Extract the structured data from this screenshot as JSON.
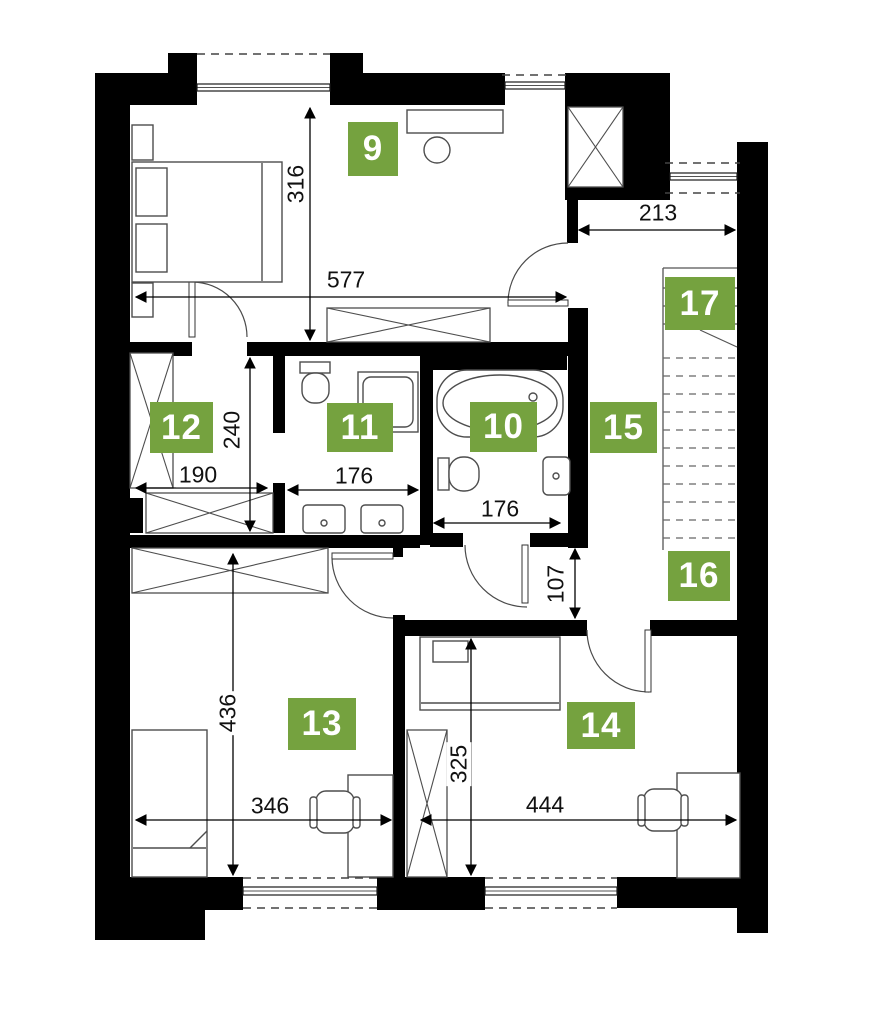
{
  "colors": {
    "wall": "#000000",
    "badge_green": "#75a23f",
    "furniture_line": "#4d4d4d",
    "dim_line": "#000000",
    "dash_line": "#444444"
  },
  "badges": [
    {
      "label": "9",
      "x": 348,
      "y": 122,
      "w": 50,
      "h": 54
    },
    {
      "label": "10",
      "x": 470,
      "y": 402,
      "w": 67,
      "h": 50
    },
    {
      "label": "11",
      "x": 327,
      "y": 403,
      "w": 66,
      "h": 49
    },
    {
      "label": "12",
      "x": 150,
      "y": 402,
      "w": 63,
      "h": 51
    },
    {
      "label": "13",
      "x": 288,
      "y": 698,
      "w": 68,
      "h": 52
    },
    {
      "label": "14",
      "x": 567,
      "y": 702,
      "w": 68,
      "h": 47
    },
    {
      "label": "15",
      "x": 590,
      "y": 402,
      "w": 67,
      "h": 51
    },
    {
      "label": "16",
      "x": 668,
      "y": 551,
      "w": 62,
      "h": 50
    },
    {
      "label": "17",
      "x": 665,
      "y": 277,
      "w": 70,
      "h": 53
    }
  ],
  "dimensions": [
    {
      "label": "316",
      "rot": true,
      "x1": 310,
      "y1": 108,
      "x2": 310,
      "y2": 340,
      "tx": 296,
      "ty": 184
    },
    {
      "label": "577",
      "rot": false,
      "x1": 136,
      "y1": 297,
      "x2": 566,
      "y2": 297,
      "tx": 346,
      "ty": 280
    },
    {
      "label": "213",
      "rot": false,
      "x1": 579,
      "y1": 230,
      "x2": 735,
      "y2": 230,
      "tx": 658,
      "ty": 213
    },
    {
      "label": "240",
      "rot": true,
      "x1": 250,
      "y1": 358,
      "x2": 250,
      "y2": 531,
      "tx": 232,
      "ty": 430
    },
    {
      "label": "190",
      "rot": false,
      "x1": 136,
      "y1": 488,
      "x2": 267,
      "y2": 488,
      "tx": 198,
      "ty": 475
    },
    {
      "label": "176",
      "rot": false,
      "x1": 288,
      "y1": 490,
      "x2": 418,
      "y2": 490,
      "tx": 354,
      "ty": 476
    },
    {
      "label": "176",
      "rot": false,
      "x1": 434,
      "y1": 523,
      "x2": 560,
      "y2": 523,
      "tx": 500,
      "ty": 509
    },
    {
      "label": "107",
      "rot": true,
      "x1": 575,
      "y1": 549,
      "x2": 575,
      "y2": 618,
      "tx": 556,
      "ty": 584
    },
    {
      "label": "436",
      "rot": true,
      "x1": 233,
      "y1": 554,
      "x2": 233,
      "y2": 875,
      "tx": 228,
      "ty": 713
    },
    {
      "label": "346",
      "rot": false,
      "x1": 136,
      "y1": 820,
      "x2": 391,
      "y2": 820,
      "tx": 270,
      "ty": 806
    },
    {
      "label": "325",
      "rot": true,
      "x1": 471,
      "y1": 639,
      "x2": 471,
      "y2": 875,
      "tx": 459,
      "ty": 764
    },
    {
      "label": "444",
      "rot": false,
      "x1": 421,
      "y1": 820,
      "x2": 736,
      "y2": 820,
      "tx": 545,
      "ty": 805
    }
  ],
  "walls": [
    {
      "name": "left-wall",
      "x": 95,
      "y": 73,
      "w": 35,
      "h": 867
    },
    {
      "name": "top-wall-left",
      "x": 95,
      "y": 73,
      "w": 102,
      "h": 32
    },
    {
      "name": "top-wall-mid",
      "x": 330,
      "y": 73,
      "w": 175,
      "h": 32
    },
    {
      "name": "top-right-block",
      "x": 565,
      "y": 73,
      "w": 105,
      "h": 127
    },
    {
      "name": "pillar-left",
      "x": 168,
      "y": 53,
      "w": 29,
      "h": 21
    },
    {
      "name": "pillar-mid",
      "x": 330,
      "y": 53,
      "w": 33,
      "h": 21
    },
    {
      "name": "right-wall",
      "x": 737,
      "y": 142,
      "w": 31,
      "h": 791
    },
    {
      "name": "bottom-wall-left",
      "x": 95,
      "y": 877,
      "w": 148,
      "h": 33
    },
    {
      "name": "bottom-corner-left",
      "x": 95,
      "y": 877,
      "w": 110,
      "h": 63
    },
    {
      "name": "bottom-wall-mid",
      "x": 377,
      "y": 877,
      "w": 108,
      "h": 33
    },
    {
      "name": "bottom-wall-right",
      "x": 617,
      "y": 877,
      "w": 123,
      "h": 31
    },
    {
      "name": "chimney-stub",
      "x": 720,
      "y": 843,
      "w": 20,
      "h": 35
    },
    {
      "name": "wall-room9-south-a",
      "x": 130,
      "y": 342,
      "w": 62,
      "h": 14
    },
    {
      "name": "wall-room9-south-b",
      "x": 247,
      "y": 342,
      "w": 180,
      "h": 14
    },
    {
      "name": "wall-bath10-north",
      "x": 427,
      "y": 342,
      "w": 161,
      "h": 14
    },
    {
      "name": "wall-bath10-north-in",
      "x": 427,
      "y": 356,
      "w": 140,
      "h": 14
    },
    {
      "name": "wall-12-11-upper",
      "x": 273,
      "y": 342,
      "w": 12,
      "h": 91
    },
    {
      "name": "wall-12-11-lower",
      "x": 273,
      "y": 483,
      "w": 12,
      "h": 50
    },
    {
      "name": "wall-11-10",
      "x": 420,
      "y": 342,
      "w": 13,
      "h": 203
    },
    {
      "name": "wall-south-baths",
      "x": 130,
      "y": 535,
      "w": 290,
      "h": 13
    },
    {
      "name": "wall-bath10-south-l",
      "x": 430,
      "y": 533,
      "w": 33,
      "h": 14
    },
    {
      "name": "wall-bath10-south-r",
      "x": 530,
      "y": 533,
      "w": 58,
      "h": 14
    },
    {
      "name": "wall-hall-west",
      "x": 568,
      "y": 308,
      "w": 20,
      "h": 240
    },
    {
      "name": "wall-hall-west-stub",
      "x": 567,
      "y": 190,
      "w": 11,
      "h": 53
    },
    {
      "name": "jamb-room13",
      "x": 393,
      "y": 537,
      "w": 10,
      "h": 20
    },
    {
      "name": "partition-13-14",
      "x": 393,
      "y": 615,
      "w": 12,
      "h": 262
    },
    {
      "name": "wall-hall-south-left",
      "x": 405,
      "y": 620,
      "w": 182,
      "h": 16
    },
    {
      "name": "wall-hall-south-right",
      "x": 650,
      "y": 620,
      "w": 90,
      "h": 16
    },
    {
      "name": "stub-room12",
      "x": 130,
      "y": 498,
      "w": 13,
      "h": 35
    }
  ],
  "white_rects": [
    {
      "name": "chimney-notch",
      "x": 726,
      "y": 850,
      "w": 11,
      "h": 27
    }
  ],
  "windows": [
    {
      "name": "window-top-left",
      "x": 197,
      "y": 84,
      "w": 133,
      "h": 7
    },
    {
      "name": "window-top-right",
      "x": 505,
      "y": 82,
      "w": 60,
      "h": 7
    },
    {
      "name": "window-right",
      "x": 670,
      "y": 173,
      "w": 67,
      "h": 7
    },
    {
      "name": "window-bottom-left",
      "x": 243,
      "y": 887,
      "w": 134,
      "h": 8
    },
    {
      "name": "window-bottom-right",
      "x": 485,
      "y": 887,
      "w": 132,
      "h": 8
    }
  ],
  "dash_lines": [
    {
      "x1": 197,
      "y1": 54,
      "x2": 330,
      "y2": 54
    },
    {
      "x1": 502,
      "y1": 75,
      "x2": 568,
      "y2": 75
    },
    {
      "x1": 665,
      "y1": 163,
      "x2": 740,
      "y2": 163
    },
    {
      "x1": 665,
      "y1": 193,
      "x2": 740,
      "y2": 193
    },
    {
      "x1": 243,
      "y1": 878,
      "x2": 377,
      "y2": 878
    },
    {
      "x1": 243,
      "y1": 908,
      "x2": 377,
      "y2": 908
    },
    {
      "x1": 485,
      "y1": 878,
      "x2": 617,
      "y2": 878
    },
    {
      "x1": 485,
      "y1": 908,
      "x2": 617,
      "y2": 908
    }
  ],
  "stairs": {
    "x1": 663,
    "x2": 737,
    "boundary": [
      {
        "x1": 663,
        "y1": 268,
        "x2": 737,
        "y2": 268
      },
      {
        "x1": 663,
        "y1": 268,
        "x2": 663,
        "y2": 550
      }
    ],
    "solid_treads_y": [
      288,
      306,
      324
    ],
    "dashed_treads_y": [
      358,
      376,
      394,
      412,
      430,
      448,
      466,
      484,
      502,
      520,
      538
    ],
    "cut_line": {
      "x1": 700,
      "y1": 330,
      "x2": 737,
      "y2": 347
    }
  },
  "doors": [
    {
      "name": "door-room9",
      "leaf": {
        "x": 508,
        "y": 300,
        "w": 60,
        "h": 6
      },
      "arc": "M 508,303 A 60 60 0 0 1 568,243"
    },
    {
      "name": "door-room12",
      "leaf": {
        "x": 189,
        "y": 282,
        "w": 6,
        "h": 55
      },
      "arc": "M 192,282 A 55 55 0 0 1 247,337"
    },
    {
      "name": "door-room13",
      "leaf": {
        "x": 332,
        "y": 553,
        "w": 61,
        "h": 6
      },
      "arc": "M 332,557 A 61 61 0 0 0 393,618"
    },
    {
      "name": "door-room10",
      "leaf": {
        "x": 522,
        "y": 545,
        "w": 6,
        "h": 58
      },
      "arc": "M 465,545 A 62 62 0 0 0 527,607"
    },
    {
      "name": "door-room14",
      "leaf": {
        "x": 645,
        "y": 630,
        "w": 6,
        "h": 62
      },
      "arc": "M 587,630 A 62 62 0 0 0 649,692"
    }
  ],
  "cross_boxes": [
    {
      "name": "shaft",
      "x": 568,
      "y": 107,
      "w": 55,
      "h": 80
    },
    {
      "name": "sideboard-room9",
      "x": 327,
      "y": 308,
      "w": 163,
      "h": 34
    },
    {
      "name": "wardrobe-room12-tall",
      "x": 130,
      "y": 353,
      "w": 43,
      "h": 135
    },
    {
      "name": "wardrobe-room12-low",
      "x": 146,
      "y": 493,
      "w": 127,
      "h": 40
    },
    {
      "name": "sideboard-room13",
      "x": 132,
      "y": 548,
      "w": 196,
      "h": 45
    },
    {
      "name": "wardrobe-room14",
      "x": 407,
      "y": 730,
      "w": 40,
      "h": 147
    }
  ],
  "furniture": [
    {
      "name": "bed-room9-frame",
      "t": "rect",
      "x": 132,
      "y": 162,
      "w": 150,
      "h": 120
    },
    {
      "name": "bed-room9-blanket-line",
      "t": "line",
      "x1": 262,
      "y1": 163,
      "x2": 262,
      "y2": 281
    },
    {
      "name": "bed-room9-pillow-1",
      "t": "rect",
      "x": 136,
      "y": 168,
      "w": 31,
      "h": 48
    },
    {
      "name": "bed-room9-pillow-2",
      "t": "rect",
      "x": 136,
      "y": 224,
      "w": 31,
      "h": 48
    },
    {
      "name": "nightstand-top",
      "t": "rect",
      "x": 132,
      "y": 125,
      "w": 21,
      "h": 35
    },
    {
      "name": "nightstand-bottom",
      "t": "rect",
      "x": 132,
      "y": 283,
      "w": 21,
      "h": 34
    },
    {
      "name": "desk-room9",
      "t": "rect",
      "x": 407,
      "y": 110,
      "w": 96,
      "h": 23
    },
    {
      "name": "stool-room9",
      "t": "circle",
      "cx": 437,
      "cy": 150,
      "r": 13
    },
    {
      "name": "toilet-room11-tank",
      "t": "rect",
      "x": 300,
      "y": 362,
      "w": 30,
      "h": 11
    },
    {
      "name": "toilet-room11-bowl",
      "t": "rrect",
      "x": 302,
      "y": 373,
      "w": 27,
      "h": 30,
      "rx": 12
    },
    {
      "name": "shower-room11-outer",
      "t": "rect",
      "x": 358,
      "y": 372,
      "w": 60,
      "h": 60
    },
    {
      "name": "shower-room11-inner",
      "t": "rrect",
      "x": 363,
      "y": 377,
      "w": 50,
      "h": 50,
      "rx": 8
    },
    {
      "name": "sink-room11-left",
      "t": "rrect",
      "x": 303,
      "y": 505,
      "w": 42,
      "h": 28,
      "rx": 4
    },
    {
      "name": "sink-room11-left-faucet",
      "t": "circle",
      "cx": 324,
      "cy": 523,
      "r": 3
    },
    {
      "name": "sink-room11-right",
      "t": "rrect",
      "x": 361,
      "y": 505,
      "w": 42,
      "h": 28,
      "rx": 4
    },
    {
      "name": "sink-room11-right-faucet",
      "t": "circle",
      "cx": 382,
      "cy": 523,
      "r": 3
    },
    {
      "name": "bathtub-room10-outer",
      "t": "rrect",
      "x": 437,
      "y": 370,
      "w": 126,
      "h": 67,
      "rx": 30
    },
    {
      "name": "bathtub-room10-inner",
      "t": "ellipse",
      "cx": 500,
      "cy": 403,
      "rx": 57,
      "ry": 28
    },
    {
      "name": "bathtub-room10-faucet",
      "t": "circle",
      "cx": 533,
      "cy": 397,
      "r": 4
    },
    {
      "name": "toilet-room10-tank",
      "t": "rect",
      "x": 438,
      "y": 458,
      "w": 11,
      "h": 32
    },
    {
      "name": "toilet-room10-bowl",
      "t": "rrect",
      "x": 449,
      "y": 457,
      "w": 30,
      "h": 34,
      "rx": 14
    },
    {
      "name": "sink-room10",
      "t": "rrect",
      "x": 543,
      "y": 457,
      "w": 27,
      "h": 38,
      "rx": 5
    },
    {
      "name": "sink-room10-faucet",
      "t": "circle",
      "cx": 556,
      "cy": 476,
      "r": 3
    },
    {
      "name": "bed-room13-frame",
      "t": "rect",
      "x": 132,
      "y": 730,
      "w": 75,
      "h": 147
    },
    {
      "name": "bed-room13-blanket-line",
      "t": "line",
      "x1": 133,
      "y1": 848,
      "x2": 206,
      "y2": 848
    },
    {
      "name": "bed-room13-fold",
      "t": "line",
      "x1": 190,
      "y1": 848,
      "x2": 207,
      "y2": 831
    },
    {
      "name": "desk-room13",
      "t": "rect",
      "x": 348,
      "y": 775,
      "w": 45,
      "h": 102
    },
    {
      "name": "chair-room13-seat",
      "t": "rrect",
      "x": 316,
      "y": 791,
      "w": 38,
      "h": 42,
      "rx": 10
    },
    {
      "name": "chair-room13-arm-left",
      "t": "rrect",
      "x": 310,
      "y": 797,
      "w": 7,
      "h": 31,
      "rx": 3
    },
    {
      "name": "chair-room13-arm-right",
      "t": "rrect",
      "x": 353,
      "y": 797,
      "w": 7,
      "h": 31,
      "rx": 3
    },
    {
      "name": "bed-room14-frame",
      "t": "rect",
      "x": 420,
      "y": 637,
      "w": 140,
      "h": 73
    },
    {
      "name": "bed-room14-pillow",
      "t": "rect",
      "x": 433,
      "y": 641,
      "w": 35,
      "h": 21
    },
    {
      "name": "bed-room14-line",
      "t": "line",
      "x1": 421,
      "y1": 703,
      "x2": 559,
      "y2": 703
    },
    {
      "name": "desk-room14",
      "t": "rect",
      "x": 677,
      "y": 773,
      "w": 63,
      "h": 105
    },
    {
      "name": "chair-room14-seat",
      "t": "rrect",
      "x": 644,
      "y": 789,
      "w": 38,
      "h": 42,
      "rx": 10
    },
    {
      "name": "chair-room14-arm-left",
      "t": "rrect",
      "x": 638,
      "y": 795,
      "w": 7,
      "h": 31,
      "rx": 3
    },
    {
      "name": "chair-room14-arm-right",
      "t": "rrect",
      "x": 681,
      "y": 795,
      "w": 7,
      "h": 31,
      "rx": 3
    }
  ]
}
